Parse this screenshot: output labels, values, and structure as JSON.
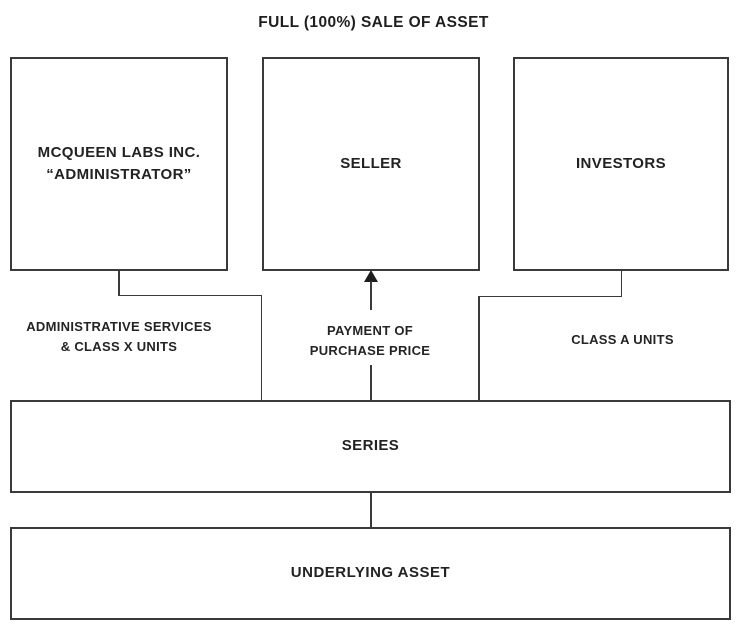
{
  "title": "FULL (100%) SALE OF ASSET",
  "nodes": {
    "administrator": {
      "name": "MCQUEEN LABS INC.",
      "subtitle": "“ADMINISTRATOR”"
    },
    "seller": {
      "name": "SELLER"
    },
    "investors": {
      "name": "INVESTORS"
    },
    "series": {
      "name": "SERIES"
    },
    "underlying_asset": {
      "name": "UNDERLYING ASSET"
    }
  },
  "edges": {
    "administrator_to_series": {
      "label_line1": "ADMINISTRATIVE SERVICES",
      "label_line2": "& CLASS X UNITS"
    },
    "series_to_seller": {
      "label_line1": "PAYMENT OF",
      "label_line2": "PURCHASE PRICE",
      "direction": "arrow-up-into-seller"
    },
    "investors_to_series": {
      "label": "CLASS A UNITS"
    }
  },
  "colors": {
    "ink": "#222222",
    "line": "#3a3a3a",
    "background": "#ffffff"
  }
}
